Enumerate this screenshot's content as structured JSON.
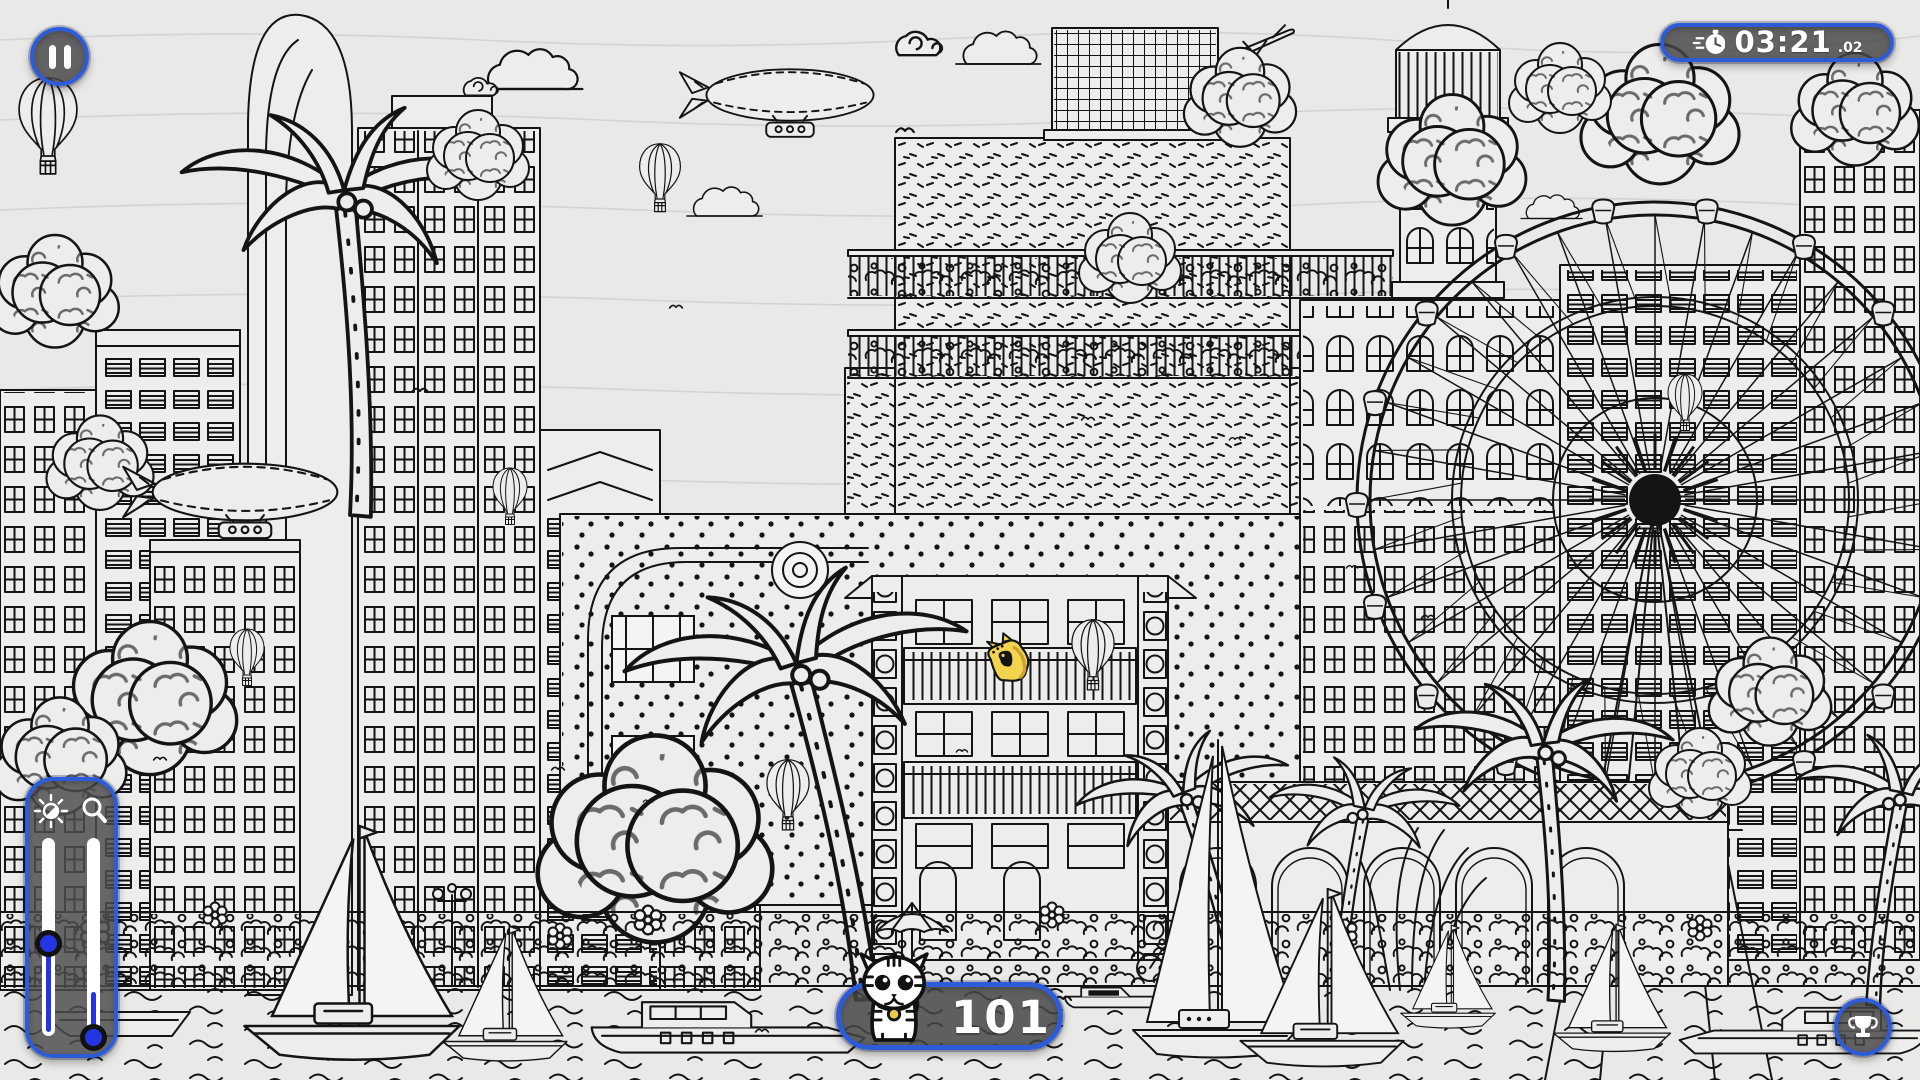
{
  "hud": {
    "pause_button": {
      "icon": "pause-icon"
    },
    "timer": {
      "icon": "stopwatch-icon",
      "time": "03:21",
      "centiseconds": ".02"
    },
    "found_counter": {
      "icon": "cat-icon",
      "count": "101"
    },
    "trophy_button": {
      "icon": "trophy-icon"
    },
    "adjust_panel": {
      "brightness_icon": "sun-icon",
      "zoom_icon": "magnifier-icon",
      "brightness_pct": 75,
      "zoom_pct": 27
    }
  },
  "scene": {
    "hidden_object": {
      "name": "yellow-cat",
      "color": "#f3d44e"
    }
  },
  "colors": {
    "hud_border": "#2e5bd8",
    "hud_fill_dark": "rgba(72,72,72,0.84)",
    "accent_blue": "#2436e2",
    "ink": "#141414",
    "paper": "#e9eae8"
  }
}
